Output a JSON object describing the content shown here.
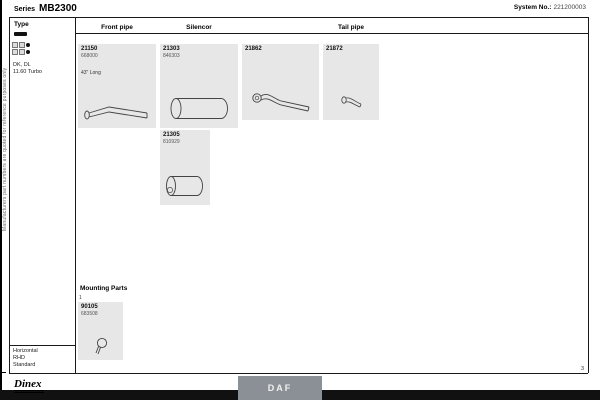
{
  "header": {
    "series_label": "Series",
    "series_value": "MB2300",
    "system_label": "System No.:",
    "system_value": "221200003"
  },
  "side_note": "Manufacturers part numbers are quoted for reference purposes only",
  "sidebar": {
    "type_label": "Type",
    "chassis_icon": "chassis-bar-icon",
    "config_icons": [
      "axle-config-icon",
      "axle-config-icon"
    ],
    "model_line1": "DK, DL",
    "model_line2": "11.60 Turbo",
    "footer_line1": "Horizontal",
    "footer_line2": "RHD",
    "footer_line3": "Standard"
  },
  "columns": {
    "front_pipe": "Front pipe",
    "silencer": "Silencor",
    "tail_pipe": "Tail pipe"
  },
  "parts": [
    {
      "number": "21150",
      "ref": "668000",
      "note": "43\" Long",
      "icon": "zigzag-front-pipe-icon"
    },
    {
      "number": "21303",
      "ref": "846303",
      "icon": "silencer-cylinder-icon"
    },
    {
      "number": "21862",
      "ref": "",
      "icon": "curved-pipe-flange-icon"
    },
    {
      "number": "21872",
      "ref": "",
      "icon": "tail-pipe-icon"
    },
    {
      "number": "21305",
      "ref": "810929",
      "icon": "silencer-cylinder-icon"
    }
  ],
  "mounting": {
    "title": "Mounting Parts",
    "index": "1",
    "number": "90105",
    "ref": "683508",
    "icon": "clamp-icon"
  },
  "footer": {
    "brand": "Dinex",
    "make_button": "DAF",
    "page_number": "3"
  },
  "colors": {
    "box_bg": "#e7e7e7",
    "button_bg": "#8b9096",
    "bar": "#111111"
  }
}
